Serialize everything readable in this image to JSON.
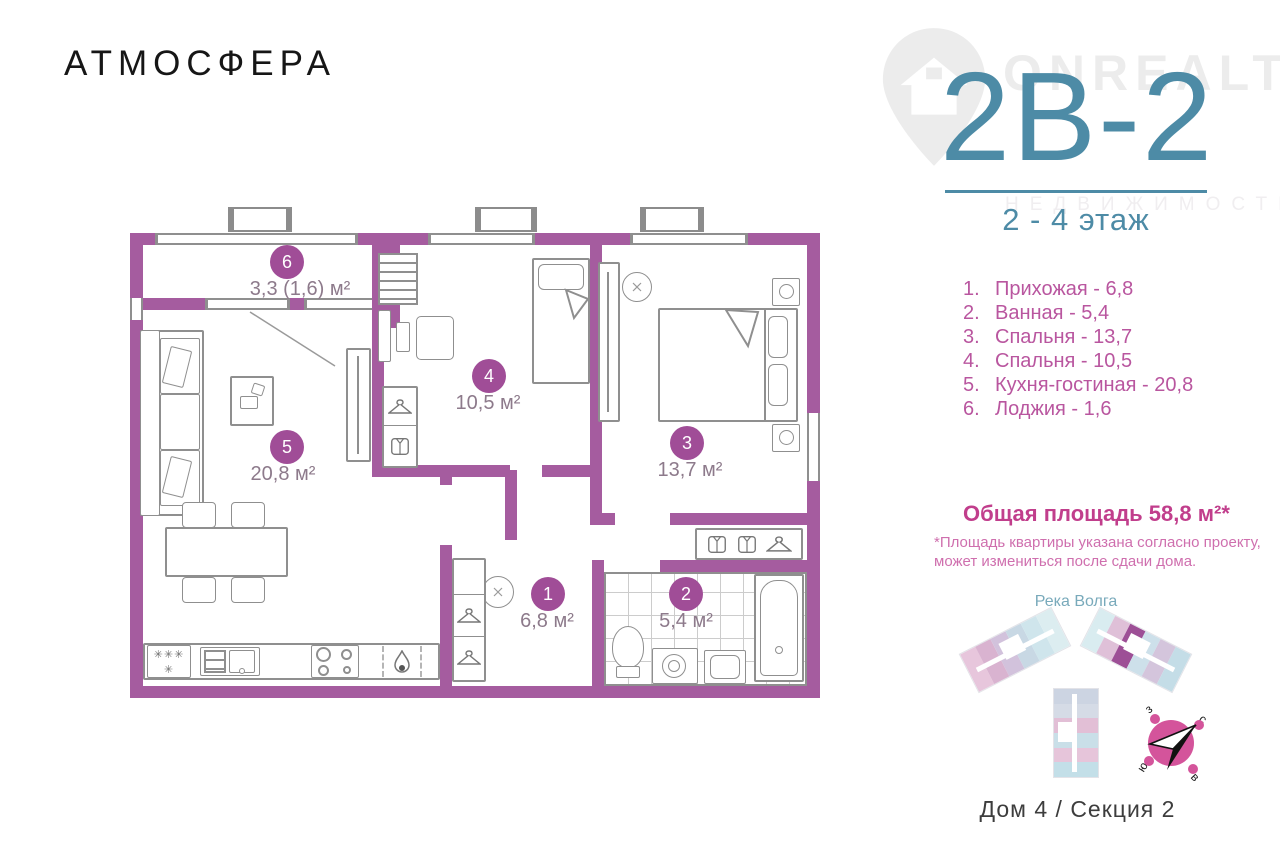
{
  "logo": "АТМОСФЕРА",
  "watermark": {
    "brand": "ONREALT",
    "tagline": "НЕДВИЖИМОСТЬ"
  },
  "unit": {
    "code": "2В-2",
    "floor_range": "2 - 4 этаж"
  },
  "rooms": [
    {
      "num": "1",
      "list_no": "1.",
      "name": "Прихожая",
      "list_text": "Прихожая - 6,8",
      "plan_label": "6,8 м²"
    },
    {
      "num": "2",
      "list_no": "2.",
      "name": "Ванная",
      "list_text": "Ванная - 5,4",
      "plan_label": "5,4 м²"
    },
    {
      "num": "3",
      "list_no": "3.",
      "name": "Спальня",
      "list_text": "Спальня - 13,7",
      "plan_label": "13,7 м²"
    },
    {
      "num": "4",
      "list_no": "4.",
      "name": "Спальня",
      "list_text": "Спальня - 10,5",
      "plan_label": "10,5 м²"
    },
    {
      "num": "5",
      "list_no": "5.",
      "name": "Кухня-гостиная",
      "list_text": "Кухня-гостиная - 20,8",
      "plan_label": "20,8 м²"
    },
    {
      "num": "6",
      "list_no": "6.",
      "name": "Лоджия",
      "list_text": "Лоджия - 1,6",
      "plan_label": "3,3 (1,6) м²"
    }
  ],
  "total_area": {
    "text": "Общая площадь 58,8 м²*",
    "disclaimer": [
      "*Площадь квартиры указана согласно проекту,",
      "может измениться после сдачи дома."
    ]
  },
  "site_plan": {
    "river_label": "Река Волга",
    "caption": "Дом 4 / Секция 2",
    "wing_left_colors": [
      "#e7c6dc",
      "#d9b3d0",
      "#d2c2dc",
      "#c8d8e4",
      "#cfe5ec",
      "#dcedf0"
    ],
    "wing_right_colors": [
      "#d9ecf0",
      "#dfc0d8",
      "#9d4f96",
      "#cde0ea",
      "#d4c5dc",
      "#c4dde7"
    ],
    "wing_bottom_colors": [
      "#ccd4e2",
      "#d5dbe6",
      "#e2bfd6",
      "#c9dfe8",
      "#e6c5da",
      "#c3dfe8"
    ],
    "highlight_unit": "#9d4f96"
  },
  "compass": {
    "west": "з",
    "north": "с",
    "south": "ю",
    "east": "в"
  },
  "fridge_marks": {
    "freezer": "✳✳✳",
    "fridge": "✳"
  },
  "colors": {
    "wall": "#a55c9f",
    "badge": "#a04d97",
    "accent_teal": "#4d8ba6",
    "list_pink": "#b9569f",
    "total_pink": "#c13e8c",
    "compass_pink": "#d4549b"
  }
}
